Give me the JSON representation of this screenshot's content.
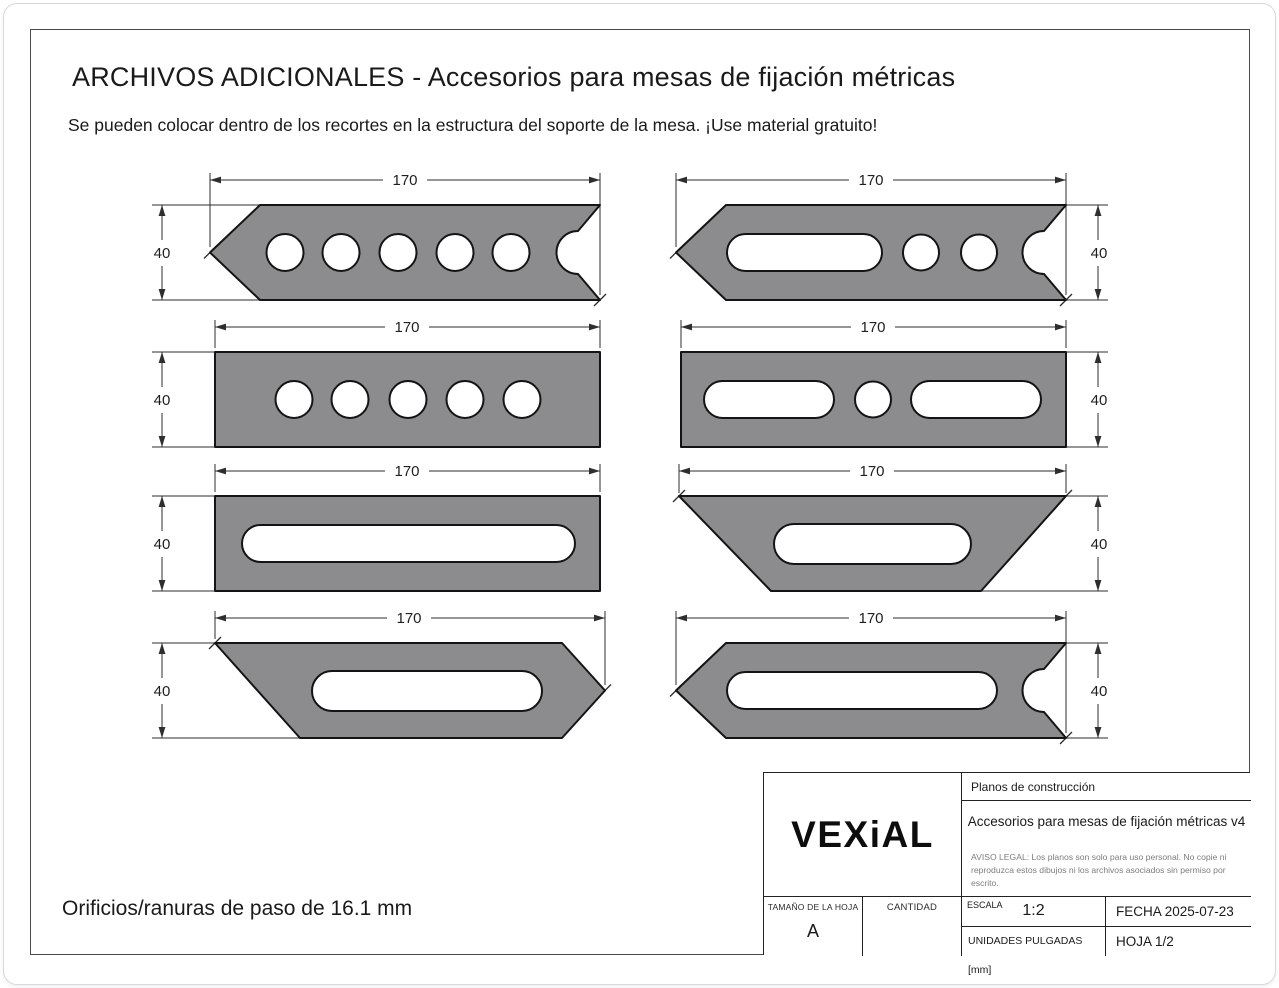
{
  "page": {
    "title": "ARCHIVOS ADICIONALES - Accesorios para mesas de fijación métricas",
    "subtitle": "Se pueden colocar dentro de los recortes en la estructura del soporte de la mesa. ¡Use material gratuito!",
    "footnote": "Orificios/ranuras de paso de 16.1 mm"
  },
  "colors": {
    "part_fill": "#8c8c8e",
    "part_outline": "#141414",
    "dimension_lines": "#2e2e2e",
    "frame_border": "#4a4a4a"
  },
  "drawings": [
    {
      "name": "arrow-strap-five-holes",
      "description": "left arrow point, round-relief V-notch right, 5 round holes",
      "width_label": "170",
      "height_label": "40",
      "dim_side": "left"
    },
    {
      "name": "arrow-strap-slot-two-holes",
      "description": "left arrow point, round-relief V-notch right, slot plus 2 round holes",
      "width_label": "170",
      "height_label": "40",
      "dim_side": "right"
    },
    {
      "name": "rect-strap-five-holes",
      "description": "rectangle with 5 round holes",
      "width_label": "170",
      "height_label": "40",
      "dim_side": "left"
    },
    {
      "name": "rect-strap-slot-hole-slot",
      "description": "rectangle with slot, round hole, slot",
      "width_label": "170",
      "height_label": "40",
      "dim_side": "right"
    },
    {
      "name": "rect-strap-long-slot",
      "description": "rectangle with one long slot",
      "width_label": "170",
      "height_label": "40",
      "dim_side": "left"
    },
    {
      "name": "trapezoid-strap-slot",
      "description": "trapezoid with central slot",
      "width_label": "170",
      "height_label": "40",
      "dim_side": "right"
    },
    {
      "name": "slant-arrow-strap-slot",
      "description": "slanted left edge, right arrow point, long slot",
      "width_label": "170",
      "height_label": "40",
      "dim_side": "left"
    },
    {
      "name": "arrow-strap-long-slot",
      "description": "left arrow point, round-relief V-notch right, long slot",
      "width_label": "170",
      "height_label": "40",
      "dim_side": "right"
    }
  ],
  "title_block": {
    "logo": "VEXiAL",
    "doc_type": "Planos de construcción",
    "doc_title": "Accesorios para mesas de fijación métricas v4",
    "legal": "AVISO LEGAL: Los planos son solo para uso personal. No copie ni reproduzca estos dibujos ni los archivos asociados sin permiso por escrito.",
    "sheet_size_label": "TAMAÑO DE LA HOJA",
    "sheet_size_value": "A",
    "quantity_label": "CANTIDAD",
    "scale_label": "ESCALA",
    "scale_value": "1:2",
    "units_label": "UNIDADES PULGADAS [mm]",
    "date_text": "FECHA 2025-07-23",
    "sheet_text": "HOJA 1/2"
  }
}
